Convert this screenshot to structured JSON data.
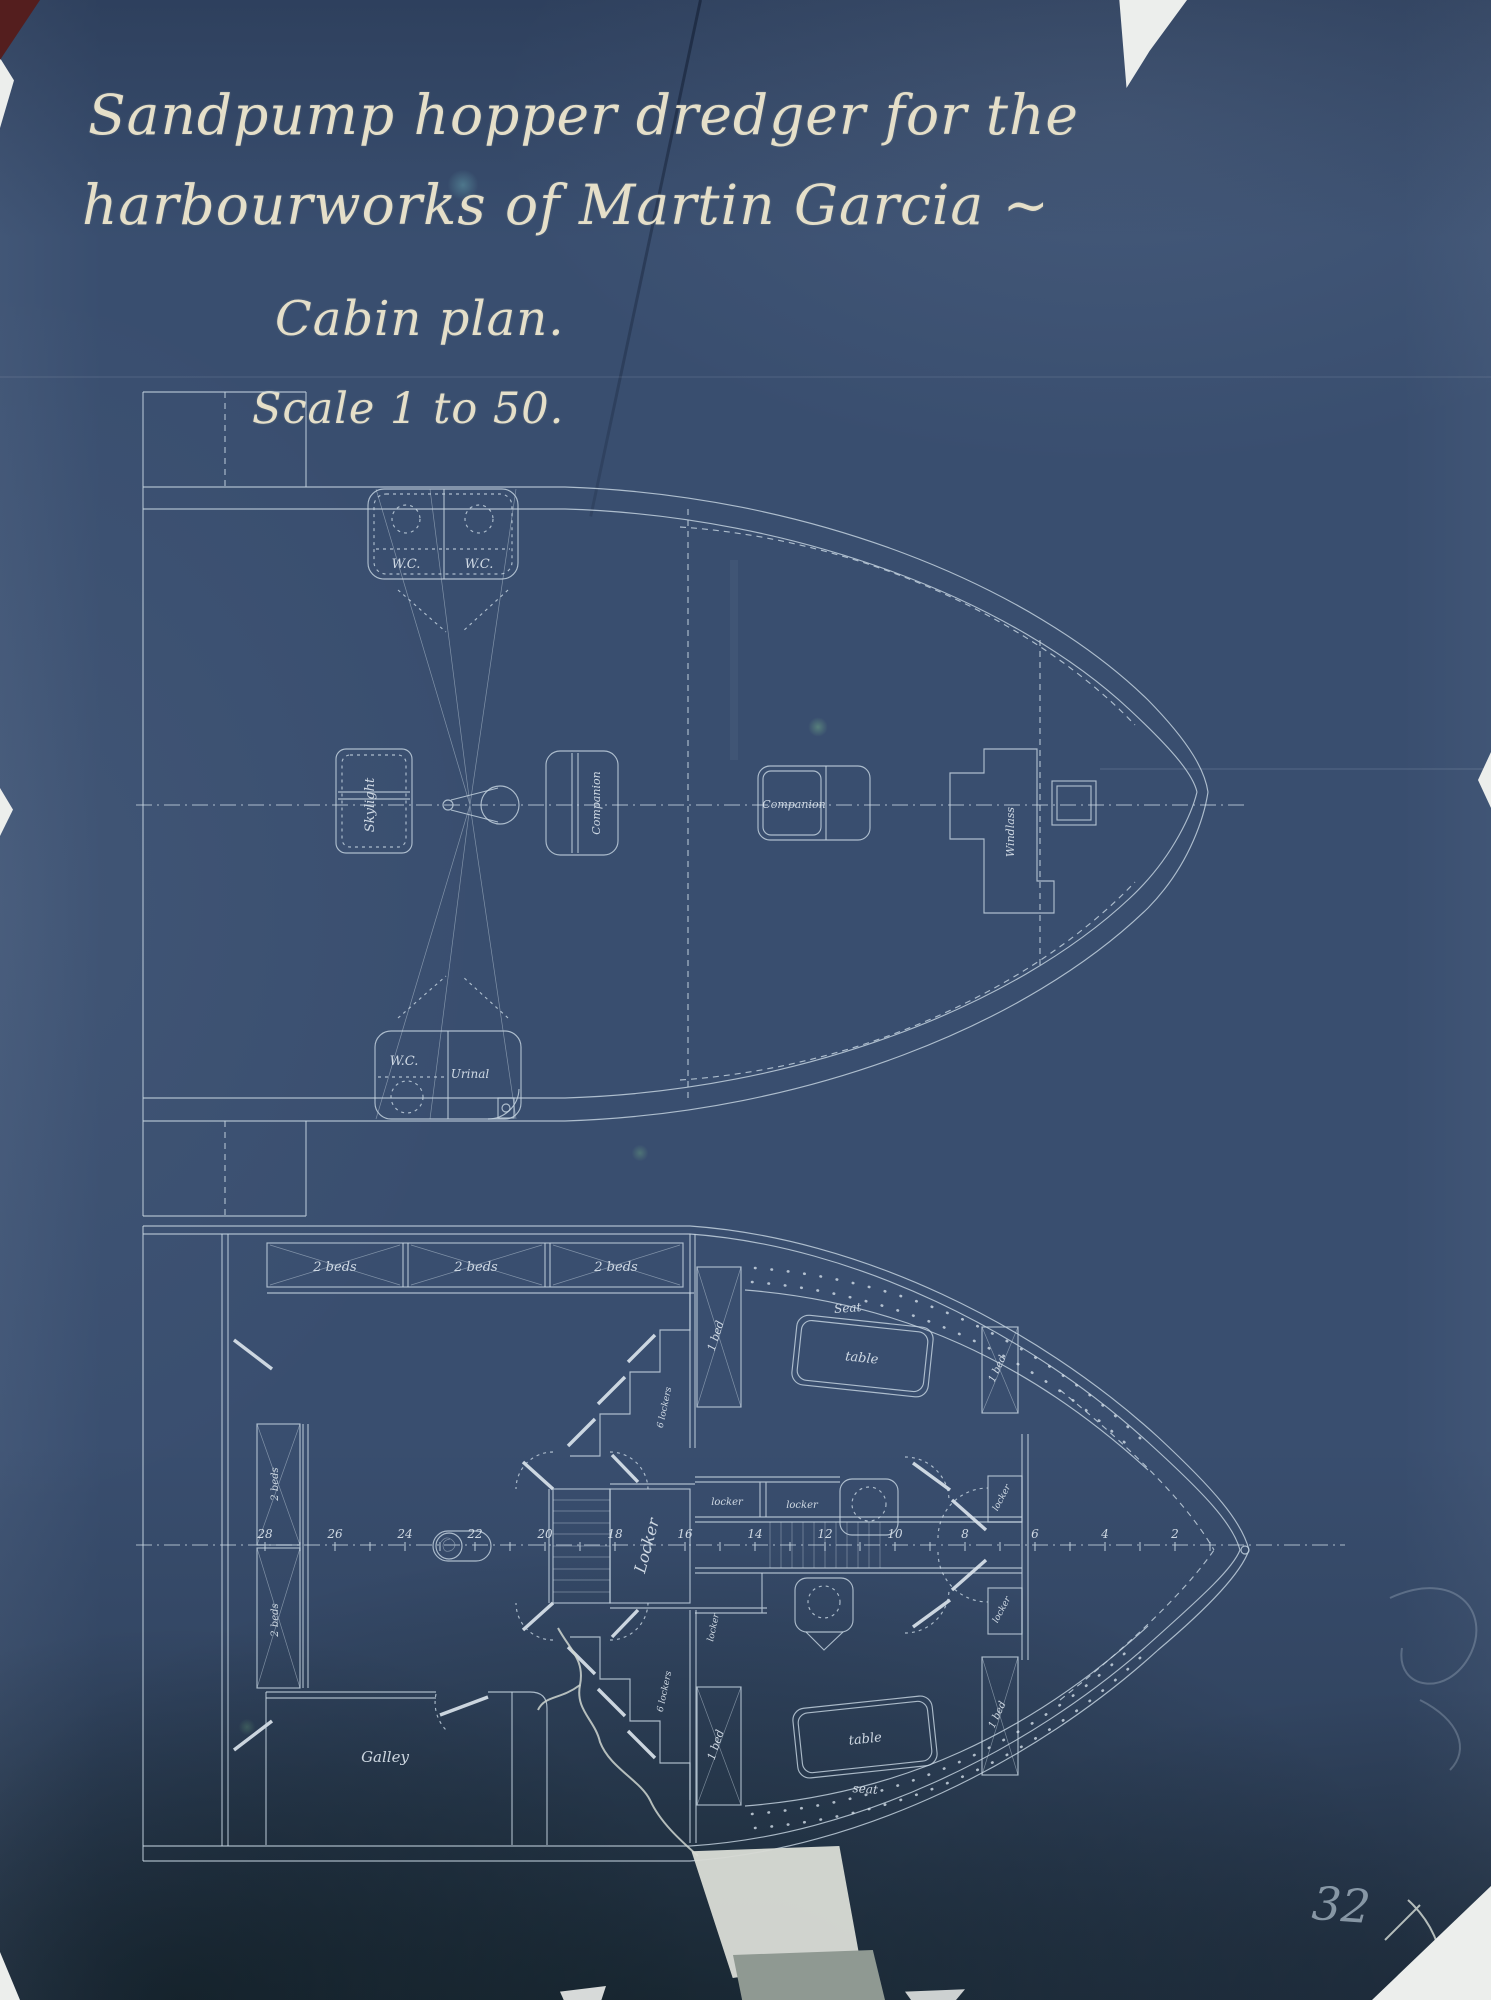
{
  "document": {
    "title_line1": "Sandpump hopper dredger for the",
    "title_line2": "harbourworks of Martin Garcia ~",
    "drawing_title": "Cabin plan.",
    "scale_note": "Scale 1 to 50.",
    "sheet_number": "32"
  },
  "deck_plan": {
    "name": "deck plan (upper drawing)",
    "labels": {
      "wc_port": "W.C.",
      "wc_starboard": "W.C.",
      "skylight": "Skylight",
      "companion_aft": "Companion",
      "companion_fwd": "Companion",
      "windlass": "Windlass",
      "wc_lower": "W.C.",
      "urinal": "Urinal"
    }
  },
  "cabin_plan": {
    "name": "cabin plan (lower drawing)",
    "labels": {
      "two_beds": "2 beds",
      "one_bed": "1 bed",
      "locker": "locker",
      "locker_room": "Locker",
      "six_lockers": "6 lockers",
      "table": "table",
      "seat_upper": "Seat",
      "seat_lower": "seat",
      "galley": "Galley"
    },
    "frame_numbers": [
      "28",
      "26",
      "24",
      "22",
      "20",
      "18",
      "16",
      "14",
      "12",
      "10",
      "8",
      "6",
      "4",
      "2"
    ]
  },
  "colors": {
    "paper": "#394e6f",
    "line": "#c7d5e2",
    "ink": "#e5dfc9",
    "pencil": "#a9b9c6"
  }
}
